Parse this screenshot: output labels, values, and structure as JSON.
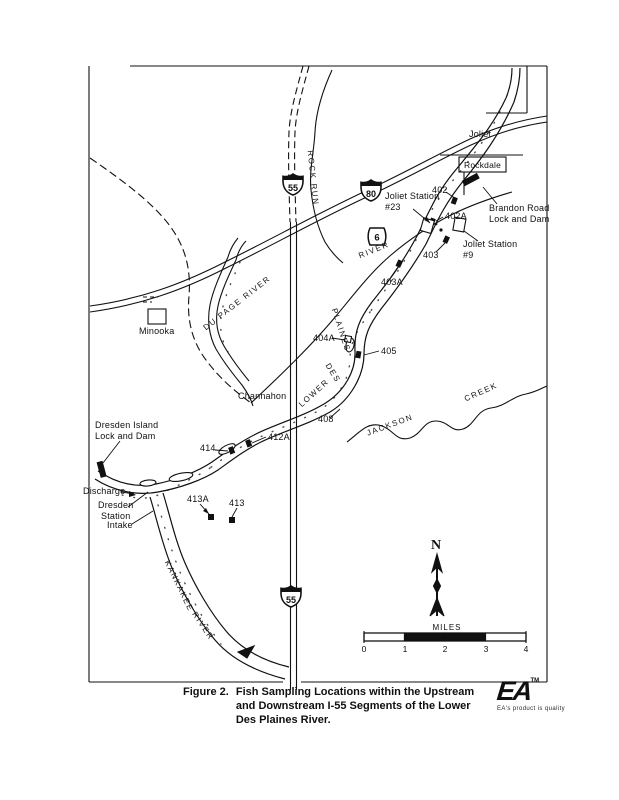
{
  "map": {
    "towns": {
      "joliet": "Joliet",
      "rockdale": "Rockdale",
      "minooka": "Minooka",
      "channahon": "Channahon"
    },
    "callouts": {
      "joliet_station_23": "Joliet Station\n#23",
      "joliet_station_9": "Joliet Station\n#9",
      "brandon_road": "Brandon Road\nLock and Dam",
      "dresden_island": "Dresden Island\nLock and Dam",
      "discharge": "Discharge",
      "dresden_station": "Dresden\nStation",
      "intake": "Intake"
    },
    "stations": {
      "s402": "402",
      "s402a": "402A",
      "s403": "403",
      "s403a": "403A",
      "s404a": "404A",
      "s405": "405",
      "s408": "408",
      "s412a": "412A",
      "s414": "414",
      "s413a": "413A",
      "s413": "413"
    },
    "waterways": {
      "du_page": "DU PAGE RIVER",
      "rock_run": "ROCK RUN",
      "lower": "LOWER",
      "des": "DES",
      "plaines": "PLAINES",
      "river": "RIVER",
      "jackson": "JACKSON",
      "creek": "CREEK",
      "kankakee": "KANKAKEE",
      "kankakee_river": "RIVER"
    },
    "highways": {
      "i55": "55",
      "i80": "80",
      "us6": "6",
      "i55_south": "55"
    },
    "compass_label": "N",
    "scalebar": {
      "title": "MILES",
      "ticks": [
        "0",
        "1",
        "2",
        "3",
        "4"
      ]
    }
  },
  "caption": {
    "label": "Figure 2.",
    "text": "Fish Sampling Locations within the Upstream\nand Downstream I-55 Segments of the Lower\nDes Plaines River."
  },
  "logo": {
    "name": "EA",
    "tm": "TM",
    "tagline": "EA's product is quality"
  },
  "colors": {
    "ink": "#111111",
    "paper": "#ffffff"
  }
}
